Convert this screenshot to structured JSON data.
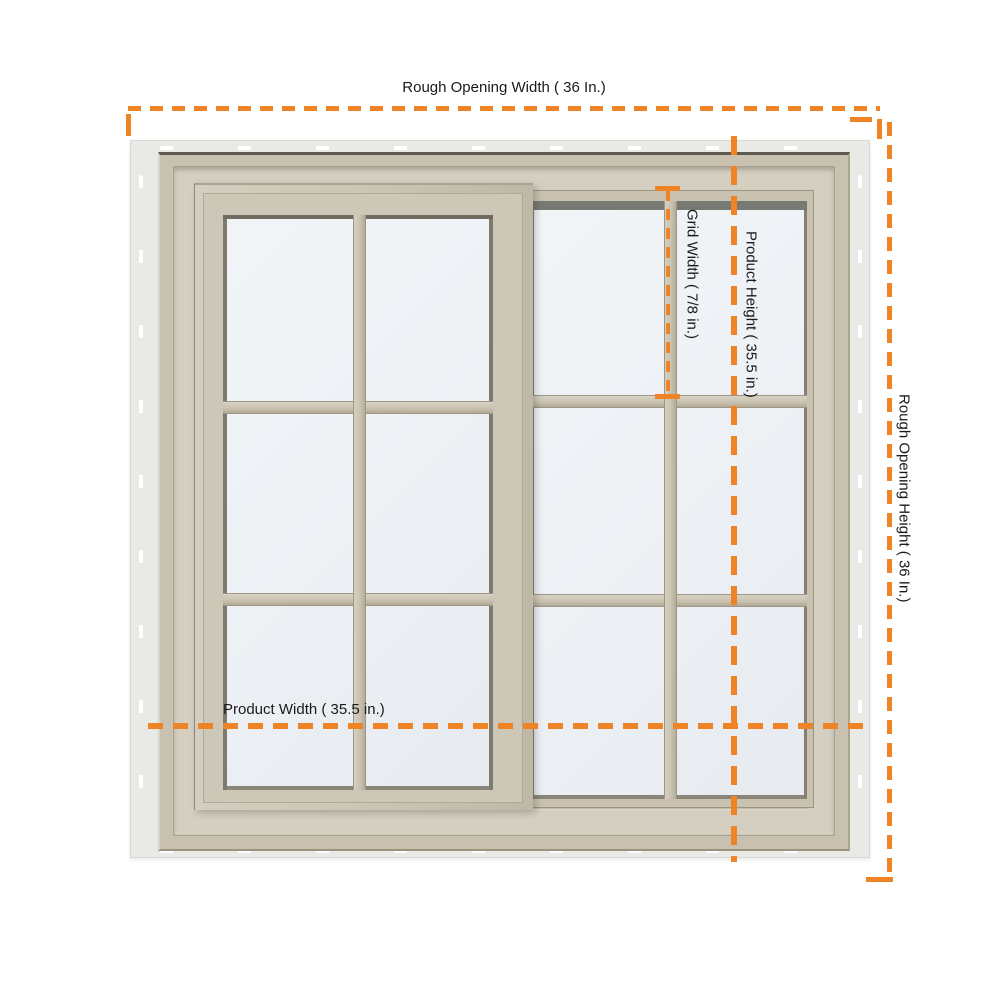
{
  "dimensions": {
    "rough_opening_width": {
      "label": "Rough Opening Width ( 36 In.)"
    },
    "rough_opening_height": {
      "label": "Rough Opening Height ( 36 In.)"
    },
    "product_width": {
      "label": "Product Width ( 35.5 in.)"
    },
    "product_height": {
      "label": "Product Height ( 35.5 in.)"
    },
    "grid_width": {
      "label": "Grid Width ( 7/8 in.)"
    }
  },
  "colors": {
    "dimension_accent": "#ee8426",
    "label_text": "#1a1a1a",
    "frame_tan": "#c9c2b0",
    "nailing_fin": "#e9eae6",
    "glass": "#edf0f4",
    "background": "#ffffff"
  }
}
